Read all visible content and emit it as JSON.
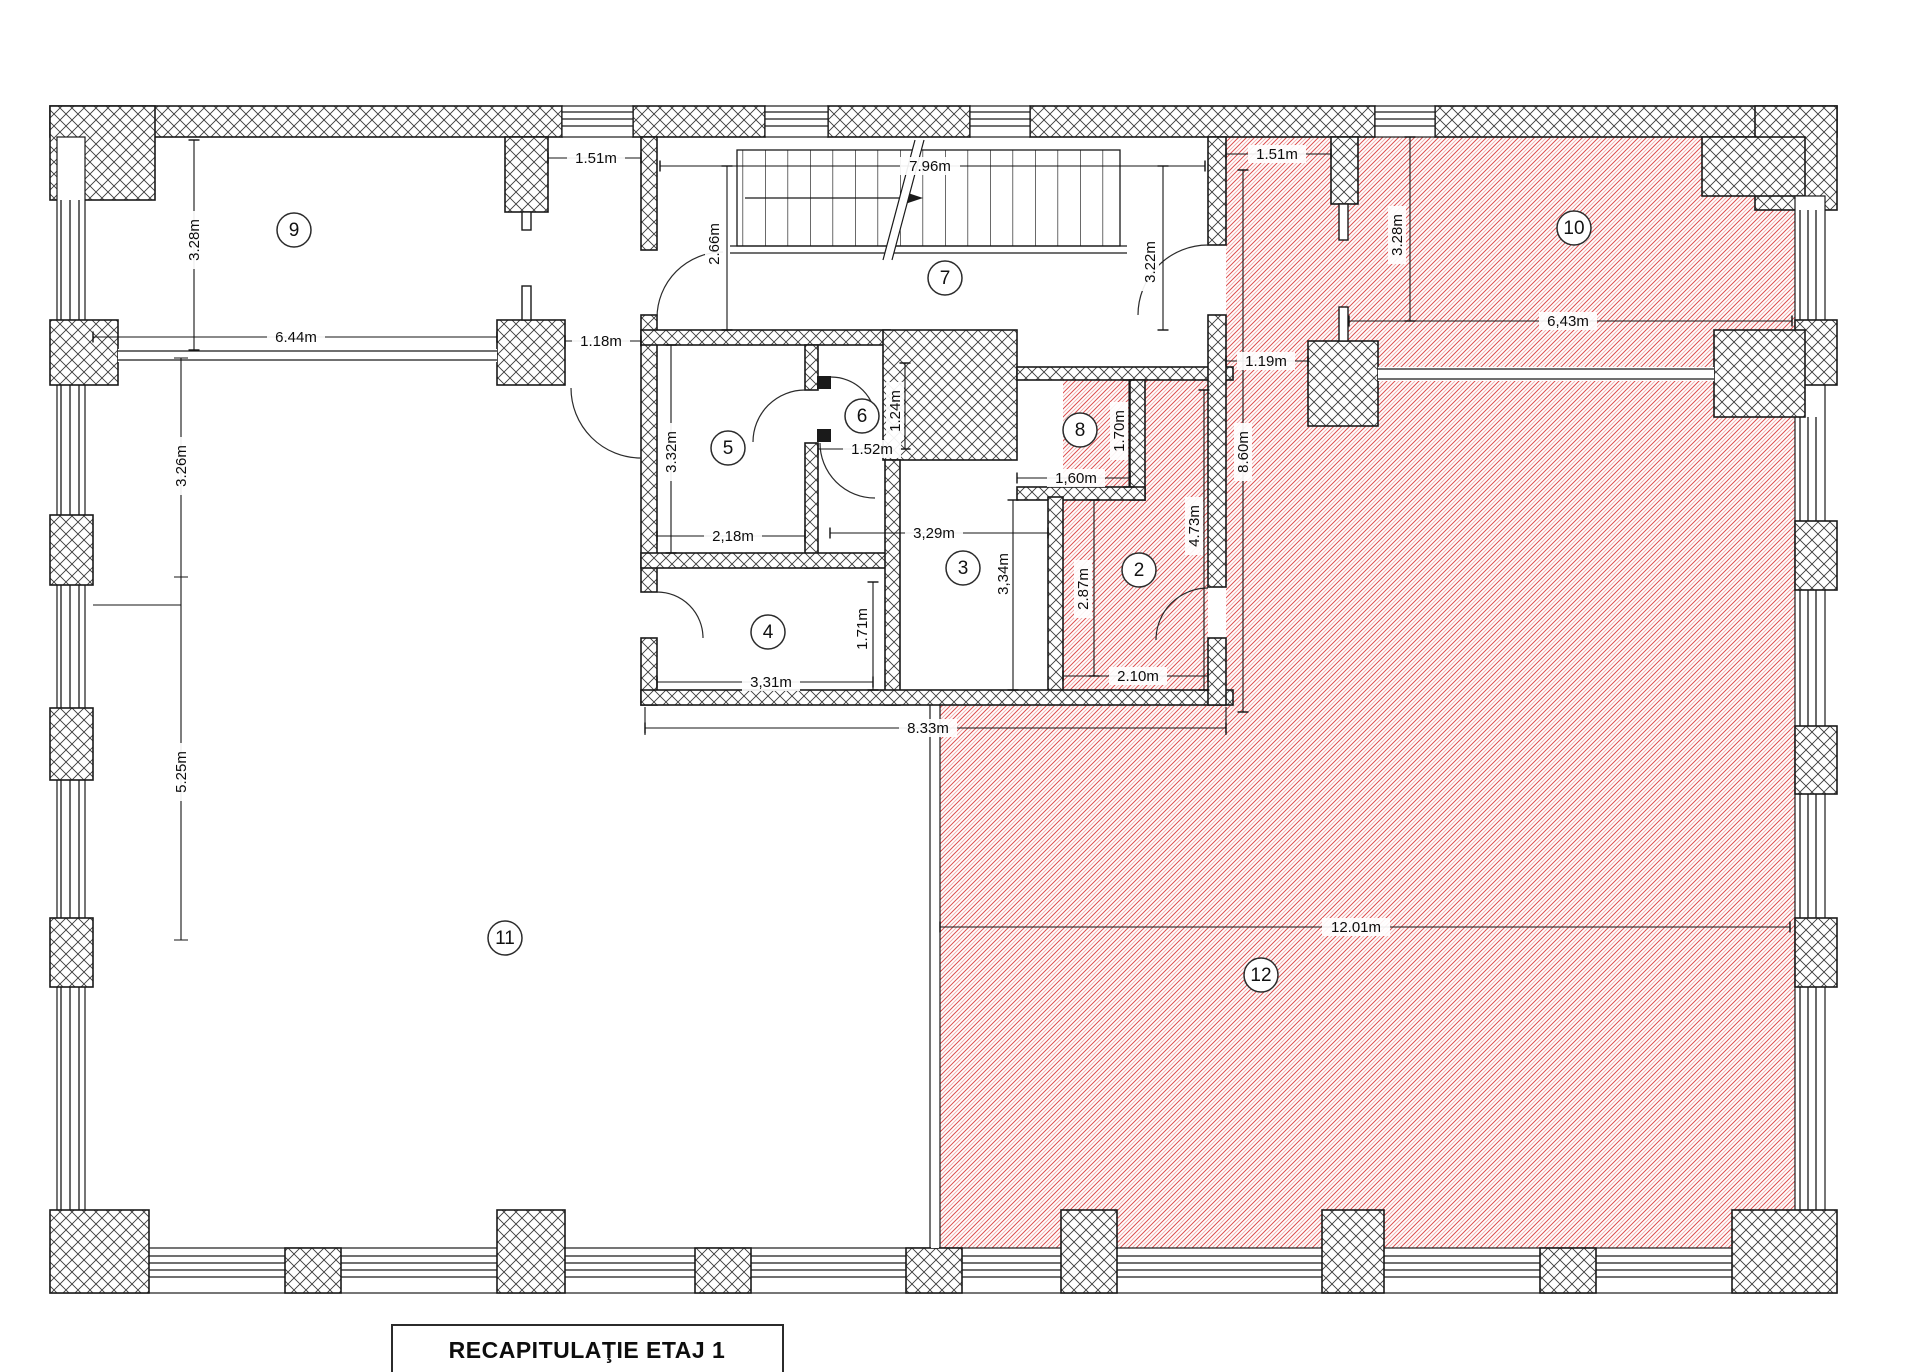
{
  "title": {
    "label": "RECAPITULAŢIE ETAJ 1"
  },
  "rooms": {
    "r2": "2",
    "r3": "3",
    "r4": "4",
    "r5": "5",
    "r6": "6",
    "r7": "7",
    "r8": "8",
    "r9": "9",
    "r10": "10",
    "r11": "11",
    "r12": "12"
  },
  "dims": {
    "top_gap_left": "1.51m",
    "stair_hall_width": "7.96m",
    "stair_left_height": "2.66m",
    "stair_right_height": "3.22m",
    "top_gap_right": "1.51m",
    "room10_height": "3.28m",
    "room10_width": "6,43m",
    "corridor_gap": "1.19m",
    "corridor_height": "8.60m",
    "room9_height": "3.28m",
    "room9_width": "6.44m",
    "passage_width": "1.18m",
    "room5_height": "3.32m",
    "room5_width": "2,18m",
    "room6_width": "1.52m",
    "room6_height": "1.24m",
    "room8_width": "1,60m",
    "room8_height": "1.70m",
    "room3_width": "3,29m",
    "room3_height": "3,34m",
    "room2_inner_height": "2.87m",
    "room2_width": "2.10m",
    "room2_height": "4.73m",
    "room4_height": "1.71m",
    "room4_width": "3,31m",
    "cluster_width": "8.33m",
    "left_wall_seg1": "3.26m",
    "left_wall_seg2": "5.25m",
    "room12_width": "12.01m"
  },
  "colors": {
    "wall_outline": "#1a1a1a",
    "crosshatch": "#3a3a3a",
    "red_hatch": "#dd4f4f",
    "red_hatch_light": "#f0abab",
    "background": "#ffffff"
  }
}
